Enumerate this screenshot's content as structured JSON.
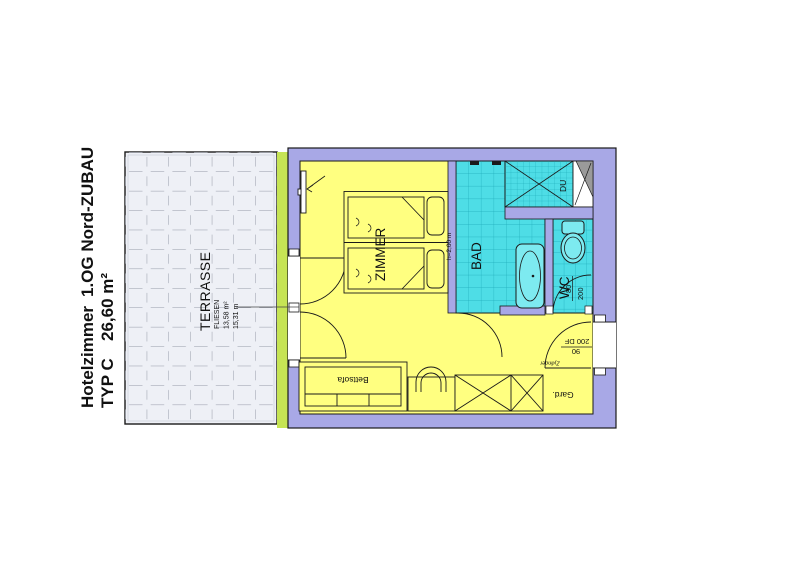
{
  "title": {
    "project": "Hotelzimmer",
    "location": "1.OG Nord-ZUBAU",
    "type_label": "TYP C",
    "area": "26,60 m²"
  },
  "terrace": {
    "name": "TERRASSE",
    "material": "FLIESEN",
    "area": "13,58 m²",
    "perimeter": "15,31 m"
  },
  "rooms": {
    "bedroom": "ZIMMER",
    "bath": "BAD",
    "shower": "DU",
    "wc": "WC"
  },
  "furniture": {
    "sofa": "Bettsofa",
    "wardrobe": "Gard."
  },
  "dimensions": {
    "bed_height": "h=2,00 m",
    "wc_door_width": "80",
    "wc_door_height": "200",
    "entry_door_height": "200 DF",
    "entry_door_width": "90",
    "entry_lock": "Zylinder"
  },
  "colors": {
    "wall": "#a8a8e6",
    "room": "#ffff80",
    "bath": "#4edde6",
    "terrace": "#eef0f6",
    "insulation": "#c6e455",
    "shaft": "#9a9a9a"
  }
}
